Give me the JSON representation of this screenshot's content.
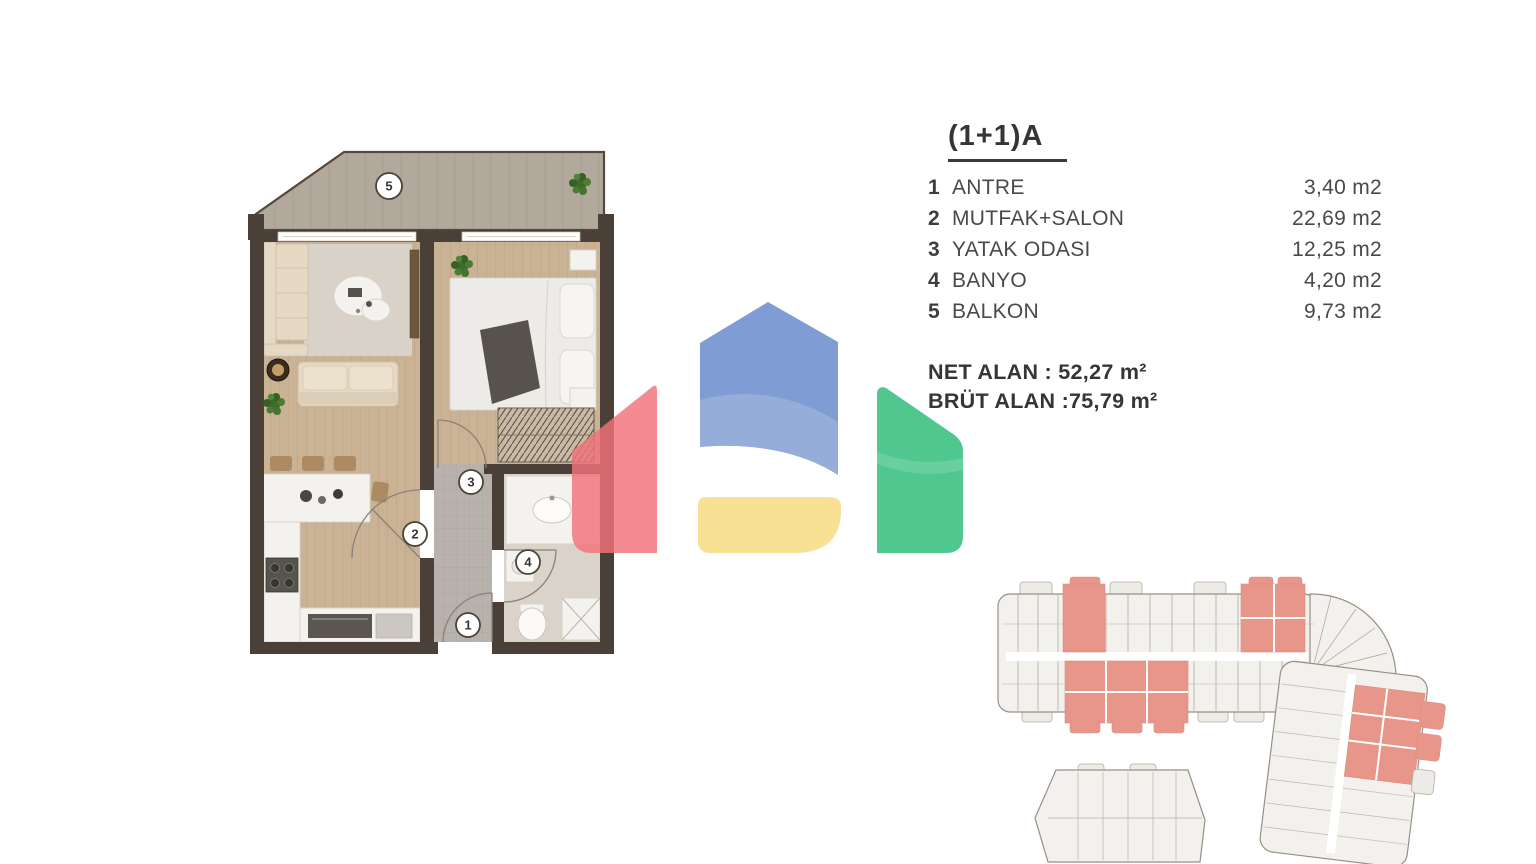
{
  "unit": {
    "title": "(1+1)A",
    "rooms": [
      {
        "num": "1",
        "name": "ANTRE",
        "area": "3,40 m2"
      },
      {
        "num": "2",
        "name": "MUTFAK+SALON",
        "area": "22,69 m2"
      },
      {
        "num": "3",
        "name": "YATAK ODASI",
        "area": "12,25 m2"
      },
      {
        "num": "4",
        "name": "BANYO",
        "area": "4,20 m2"
      },
      {
        "num": "5",
        "name": "BALKON",
        "area": "9,73 m2"
      }
    ],
    "net_alan": "NET ALAN : 52,27 m²",
    "brut_alan": "BRÜT ALAN :75,79 m²"
  },
  "colors": {
    "page_bg": "#ffffff",
    "text_dark": "#353535",
    "text_mid": "#494949",
    "logo_red": "#f2717b",
    "logo_blue": "#7f9cd5",
    "logo_blue_light": "#97add9",
    "logo_yellow": "#f8e095",
    "logo_green": "#50c78e",
    "plan_wall": "#4b4037",
    "plan_wood": "#cab294",
    "plan_deck": "#b2a89b",
    "plan_rug": "#d8d2c8",
    "plan_hall": "#b7b2ab",
    "plan_bath": "#dad3ca",
    "plan_white": "#f4f2ee",
    "plan_sofa": "#e5d9c4",
    "plan_accent_wood": "#ae8a63",
    "plan_plant": "#3f6b2c",
    "plan_line": "#8b8177",
    "site_fill": "#f3f1ed",
    "site_stroke": "#988f84",
    "site_highlight": "#e9968a"
  }
}
